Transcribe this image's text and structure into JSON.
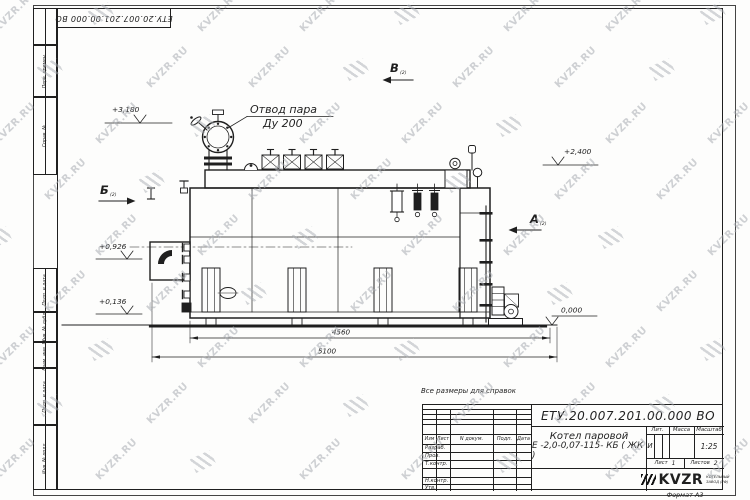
{
  "sheet": {
    "doc_number": "ЕТУ.20.007.201.00.000  ВО",
    "note": "Все размеры для справок",
    "format_label": "Формат А3",
    "margin_labels": {
      "perv": "Перв. примен.",
      "sprav": "Справ. №",
      "podp1": "Подп. и дата",
      "inv_dubl": "Инв. № дубл.",
      "vzam": "Взам. инв. №",
      "podp2": "Подп. и дата",
      "inv_podl": "Инв. № подл."
    }
  },
  "watermark": {
    "text": "KVZR.RU"
  },
  "drawing": {
    "callout": {
      "line1": "Отвод пара",
      "line2": "Ду 200"
    },
    "elevations": {
      "e1": "+3,180",
      "e2": "+2,400",
      "e3": "+0,926",
      "e4": "+0,136",
      "e5": "0,000"
    },
    "views": {
      "a": "А",
      "b": "Б",
      "v": "В",
      "sub": "(2)"
    },
    "dims": {
      "d1": "4560",
      "d2": "5100"
    }
  },
  "title_block": {
    "doc_number": "ЕТУ.20.007.201.00.000  ВО",
    "product_line1": "Котел паровой",
    "product_line2": "Е -2,0-0,07-115- КБ ( ЖК )",
    "cols": {
      "izm": "Изм",
      "list": "Лист",
      "ndoc": "N докум.",
      "podp": "Подп.",
      "data": "Дата"
    },
    "rows": {
      "razrab": "Разраб.",
      "prov": "Пров.",
      "tkontr": "Т.контр.",
      "nkontr": "Н.контр.",
      "utv": "Утв."
    },
    "lit": {
      "header": "Лит.",
      "value": "И"
    },
    "mass_header": "Масса",
    "scale": {
      "header": "Масштаб",
      "value": "1:25"
    },
    "sheet_num": {
      "label": "Лист",
      "value": "1"
    },
    "sheets_total": {
      "label": "Листов",
      "value": "2"
    },
    "logo": {
      "text": "KVZR",
      "sub1": "КОТЕЛЬНЫЙ",
      "sub2": "ЗАВОД (РФ)"
    }
  }
}
